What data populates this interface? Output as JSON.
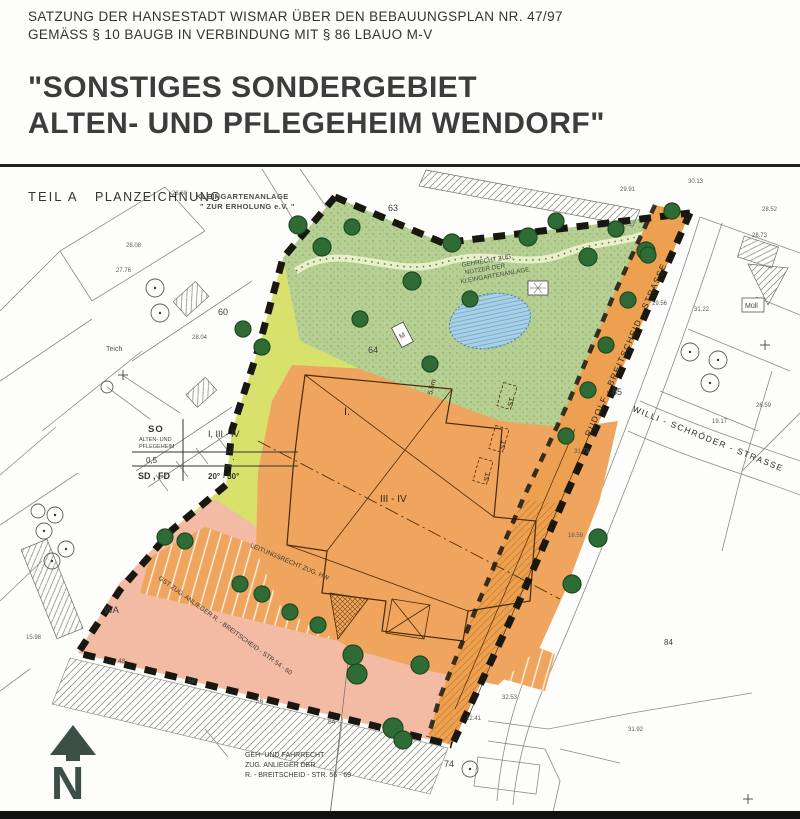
{
  "document": {
    "line1": "SATZUNG DER HANSESTADT WISMAR ÜBER DEN BEBAUUNGSPLAN NR. 47/97",
    "line2": "GEMÄSS § 10 BAUGB IN VERBINDUNG MIT § 86 LBAUO M-V",
    "title1": "\"SONSTIGES SONDERGEBIET",
    "title2": "ALTEN- UND PFLEGEHEIM WENDORF\""
  },
  "plan": {
    "part_label": "TEIL A",
    "part_name": "PLANZEICHNUNG",
    "kleingarten_line1": "KLEINGARTENANLAGE",
    "kleingarten_line2": "\" ZUR ERHOLUNG e.V. \"",
    "streets": {
      "rudolf": "RUDOLF - BREITSCHEID - STRASSE",
      "willi": "WILLI - SCHRÖDER - STRASSE"
    },
    "rights": {
      "gehrecht_l1": "GEHRECHT ZUG.",
      "gehrecht_l2": "NUTZER DER",
      "gehrecht_l3": "KLEINGARTENANLAGE",
      "leitungsrecht": "LEITUNGSRECHT ZUG. HW",
      "gst": "GST ZUG. ANLIEGER R. - BREITSCHEID - STR 54 - 60",
      "gehfahr_l1": "GEH- UND FAHRRECHT",
      "gehfahr_l2": "ZUG. ANLIEGER DER",
      "gehfahr_l3": "R. - BREITSCHEID - STR. 56 - 69"
    },
    "schablone": {
      "art": "SO",
      "art_l1": "ALTEN- UND",
      "art_l2": "PFLEGEHEIM",
      "floors": "I, III - IV",
      "grz": "0,5",
      "dot": "·",
      "roof": "SD , FD",
      "pitch": "20° - 30°"
    },
    "zones": {
      "wa": "WA",
      "floors_I": "I.",
      "floors_III_IV": "III - IV",
      "st": "ST",
      "dim": "5.5m"
    },
    "features": {
      "teich": "Teich",
      "muell": "Müll",
      "m_box": "M",
      "north": "N"
    },
    "parcels": {
      "p60": "60",
      "p63": "63",
      "p64": "64",
      "p85": "85",
      "p74": "74",
      "p84": "84",
      "p56": "56",
      "p54": "54",
      "p48": "48",
      "p58": "58"
    },
    "survey": [
      "28.60",
      "28.08",
      "27.76",
      "29.91",
      "30.13",
      "28.52",
      "28.73",
      "31.22",
      "29.56",
      "26.59",
      "19.17",
      "31.73",
      "18.59",
      "32.53",
      "31.92",
      "12.41",
      "15.98",
      "28.04"
    ],
    "colors": {
      "orange": "#efa55e",
      "street_orange": "#eda04f",
      "band_green": "#d8e16b",
      "park_green": "#b6cf92",
      "tree_green": "#2f6b35",
      "pink": "#f4bba4",
      "pond_blue": "#a9d0e6",
      "boundary_black": "#181810",
      "north_arrow": "#3c4f45"
    }
  }
}
